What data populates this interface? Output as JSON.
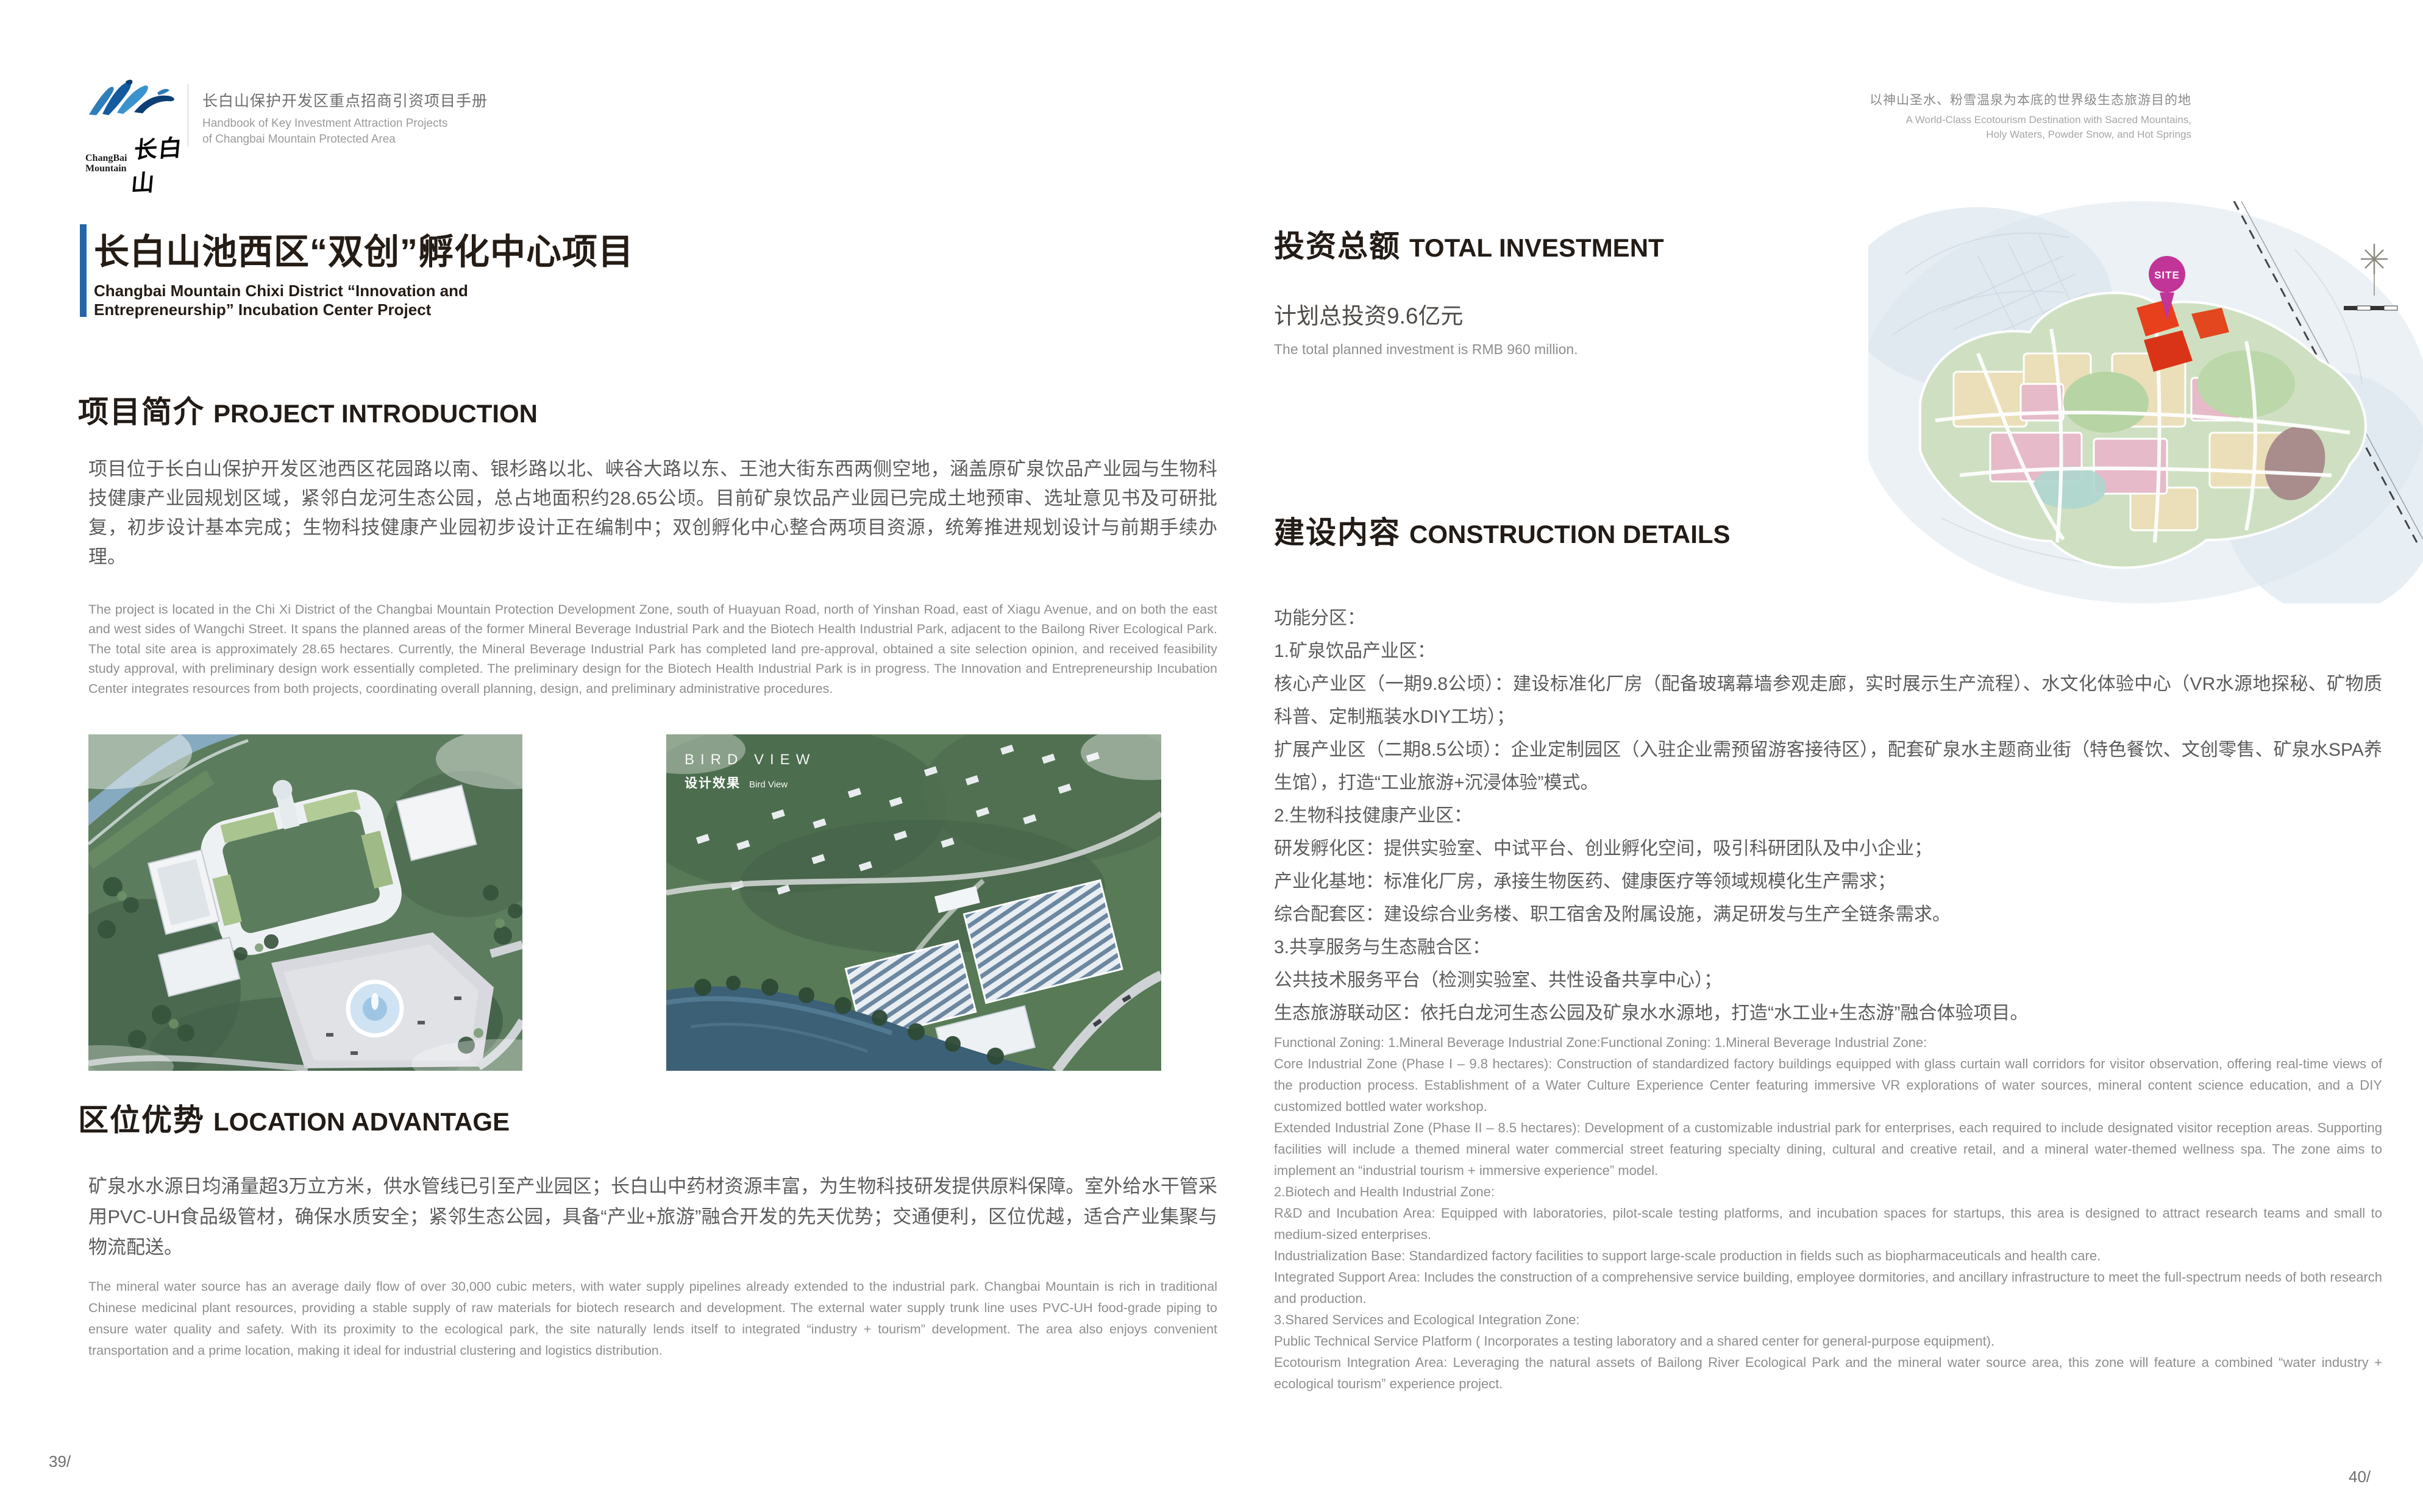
{
  "header": {
    "logo": {
      "brand_en_line1": "ChangBai",
      "brand_en_line2": "Mountain",
      "brand_zh": "长白山"
    },
    "handbook_zh": "长白山保护开发区重点招商引资项目手册",
    "handbook_en_line1": "Handbook of Key Investment Attraction Projects",
    "handbook_en_line2": "of Changbai Mountain Protected Area",
    "tagline_zh": "以神山圣水、粉雪温泉为本底的世界级生态旅游目的地",
    "tagline_en_line1": "A World-Class Ecotourism Destination with Sacred Mountains,",
    "tagline_en_line2": "Holy Waters, Powder Snow, and Hot Springs"
  },
  "left_page": {
    "title_zh": "长白山池西区“双创”孵化中心项目",
    "title_en_line1": "Changbai Mountain Chixi District “Innovation and",
    "title_en_line2": "Entrepreneurship” Incubation Center Project",
    "intro": {
      "heading_zh": "项目简介",
      "heading_en": "PROJECT INTRODUCTION",
      "body_zh": "项目位于长白山保护开发区池西区花园路以南、银杉路以北、峡谷大路以东、王池大街东西两侧空地，涵盖原矿泉饮品产业园与生物科技健康产业园规划区域，紧邻白龙河生态公园，总占地面积约28.65公顷。目前矿泉饮品产业园已完成土地预审、选址意见书及可研批复，初步设计基本完成；生物科技健康产业园初步设计正在编制中；双创孵化中心整合两项目资源，统筹推进规划设计与前期手续办理。",
      "body_en": "The project is located in the Chi Xi District of the Changbai Mountain Protection Development Zone, south of Huayuan Road, north of Yinshan Road, east of Xiagu Avenue, and on both the east and west sides of Wangchi Street. It spans the planned areas of the former Mineral Beverage Industrial Park and the Biotech Health Industrial Park, adjacent to the Bailong River Ecological Park. The total site area is approximately 28.65 hectares. Currently, the Mineral Beverage Industrial Park has completed land pre-approval, obtained a site selection opinion, and received feasibility study approval, with preliminary design work essentially completed. The preliminary design for the Biotech Health Industrial Park is in progress. The Innovation and Entrepreneurship Incubation Center integrates resources from both projects, coordinating overall planning, design, and preliminary administrative procedures."
    },
    "image2_overlay": {
      "line1": "BIRD VIEW",
      "line2_zh": "设计效果",
      "line2_en": "Bird View"
    },
    "advantage": {
      "heading_zh": "区位优势",
      "heading_en": "LOCATION ADVANTAGE",
      "body_zh": "矿泉水水源日均涌量超3万立方米，供水管线已引至产业园区；长白山中药材资源丰富，为生物科技研发提供原料保障。室外给水干管采用PVC-UH食品级管材，确保水质安全；紧邻生态公园，具备“产业+旅游”融合开发的先天优势；交通便利，区位优越，适合产业集聚与物流配送。",
      "body_en": "The mineral water source has an average daily flow of over 30,000 cubic meters, with water supply pipelines already extended to the industrial park. Changbai Mountain is rich in traditional Chinese medicinal plant resources, providing a stable supply of raw materials for biotech research and development. The external water supply trunk line uses PVC-UH food-grade piping to ensure water quality and safety. With its proximity to the ecological park, the site naturally lends itself to integrated “industry + tourism” development. The area also enjoys convenient transportation and a prime location, making it ideal for industrial clustering and logistics distribution."
    },
    "page_number": "39/"
  },
  "right_page": {
    "investment": {
      "heading_zh": "投资总额",
      "heading_en": "TOTAL INVESTMENT",
      "amount_zh": "计划总投资9.6亿元",
      "amount_en": "The total planned investment is RMB 960 million."
    },
    "construction": {
      "heading_zh": "建设内容",
      "heading_en": "CONSTRUCTION DETAILS",
      "zh_lines": [
        "功能分区：",
        "1.矿泉饮品产业区：",
        "核心产业区（一期9.8公顷）：建设标准化厂房（配备玻璃幕墙参观走廊，实时展示生产流程）、水文化体验中心（VR水源地探秘、矿物质科普、定制瓶装水DIY工坊）；",
        "扩展产业区（二期8.5公顷）：企业定制园区（入驻企业需预留游客接待区），配套矿泉水主题商业街（特色餐饮、文创零售、矿泉水SPA养生馆），打造“工业旅游+沉浸体验”模式。",
        "2.生物科技健康产业区：",
        "研发孵化区：提供实验室、中试平台、创业孵化空间，吸引科研团队及中小企业；",
        "产业化基地：标准化厂房，承接生物医药、健康医疗等领域规模化生产需求；",
        "综合配套区：建设综合业务楼、职工宿舍及附属设施，满足研发与生产全链条需求。",
        "3.共享服务与生态融合区：",
        "公共技术服务平台（检测实验室、共性设备共享中心）；",
        "生态旅游联动区：依托白龙河生态公园及矿泉水水源地，打造“水工业+生态游”融合体验项目。"
      ],
      "en_lines": [
        "Functional Zoning: 1.Mineral Beverage Industrial Zone:Functional Zoning: 1.Mineral Beverage Industrial Zone:",
        "Core Industrial Zone (Phase I – 9.8 hectares): Construction of standardized factory buildings equipped with glass curtain wall corridors for visitor observation, offering real-time views of the production process. Establishment of a Water Culture Experience Center featuring immersive VR explorations of water sources, mineral content science education, and a DIY customized bottled water workshop.",
        "Extended Industrial Zone (Phase II – 8.5 hectares): Development of a customizable industrial park for enterprises, each required to include designated visitor reception areas. Supporting facilities will include a themed mineral water commercial street featuring specialty dining, cultural and creative retail, and a mineral water-themed wellness spa. The zone aims to implement an “industrial tourism + immersive experience” model.",
        "2.Biotech and Health Industrial Zone:",
        "R&D and Incubation Area: Equipped with laboratories, pilot-scale testing platforms, and incubation spaces for startups, this area is designed to attract research teams and small to medium-sized enterprises.",
        "Industrialization Base: Standardized factory facilities to support large-scale production in fields such as biopharmaceuticals and health care.",
        "Integrated Support Area: Includes the construction of a comprehensive service building, employee dormitories, and ancillary infrastructure to meet the full-spectrum needs of both research and production.",
        "3.Shared Services and Ecological Integration Zone:",
        "Public Technical Service Platform ( Incorporates a testing laboratory and a shared center for general-purpose equipment).",
        "Ecotourism Integration Area: Leveraging the natural assets of Bailong River Ecological Park and the mineral water source area, this zone will feature a combined “water industry + ecological tourism” experience project."
      ]
    },
    "map": {
      "site_label": "SITE"
    },
    "page_number": "40/"
  }
}
